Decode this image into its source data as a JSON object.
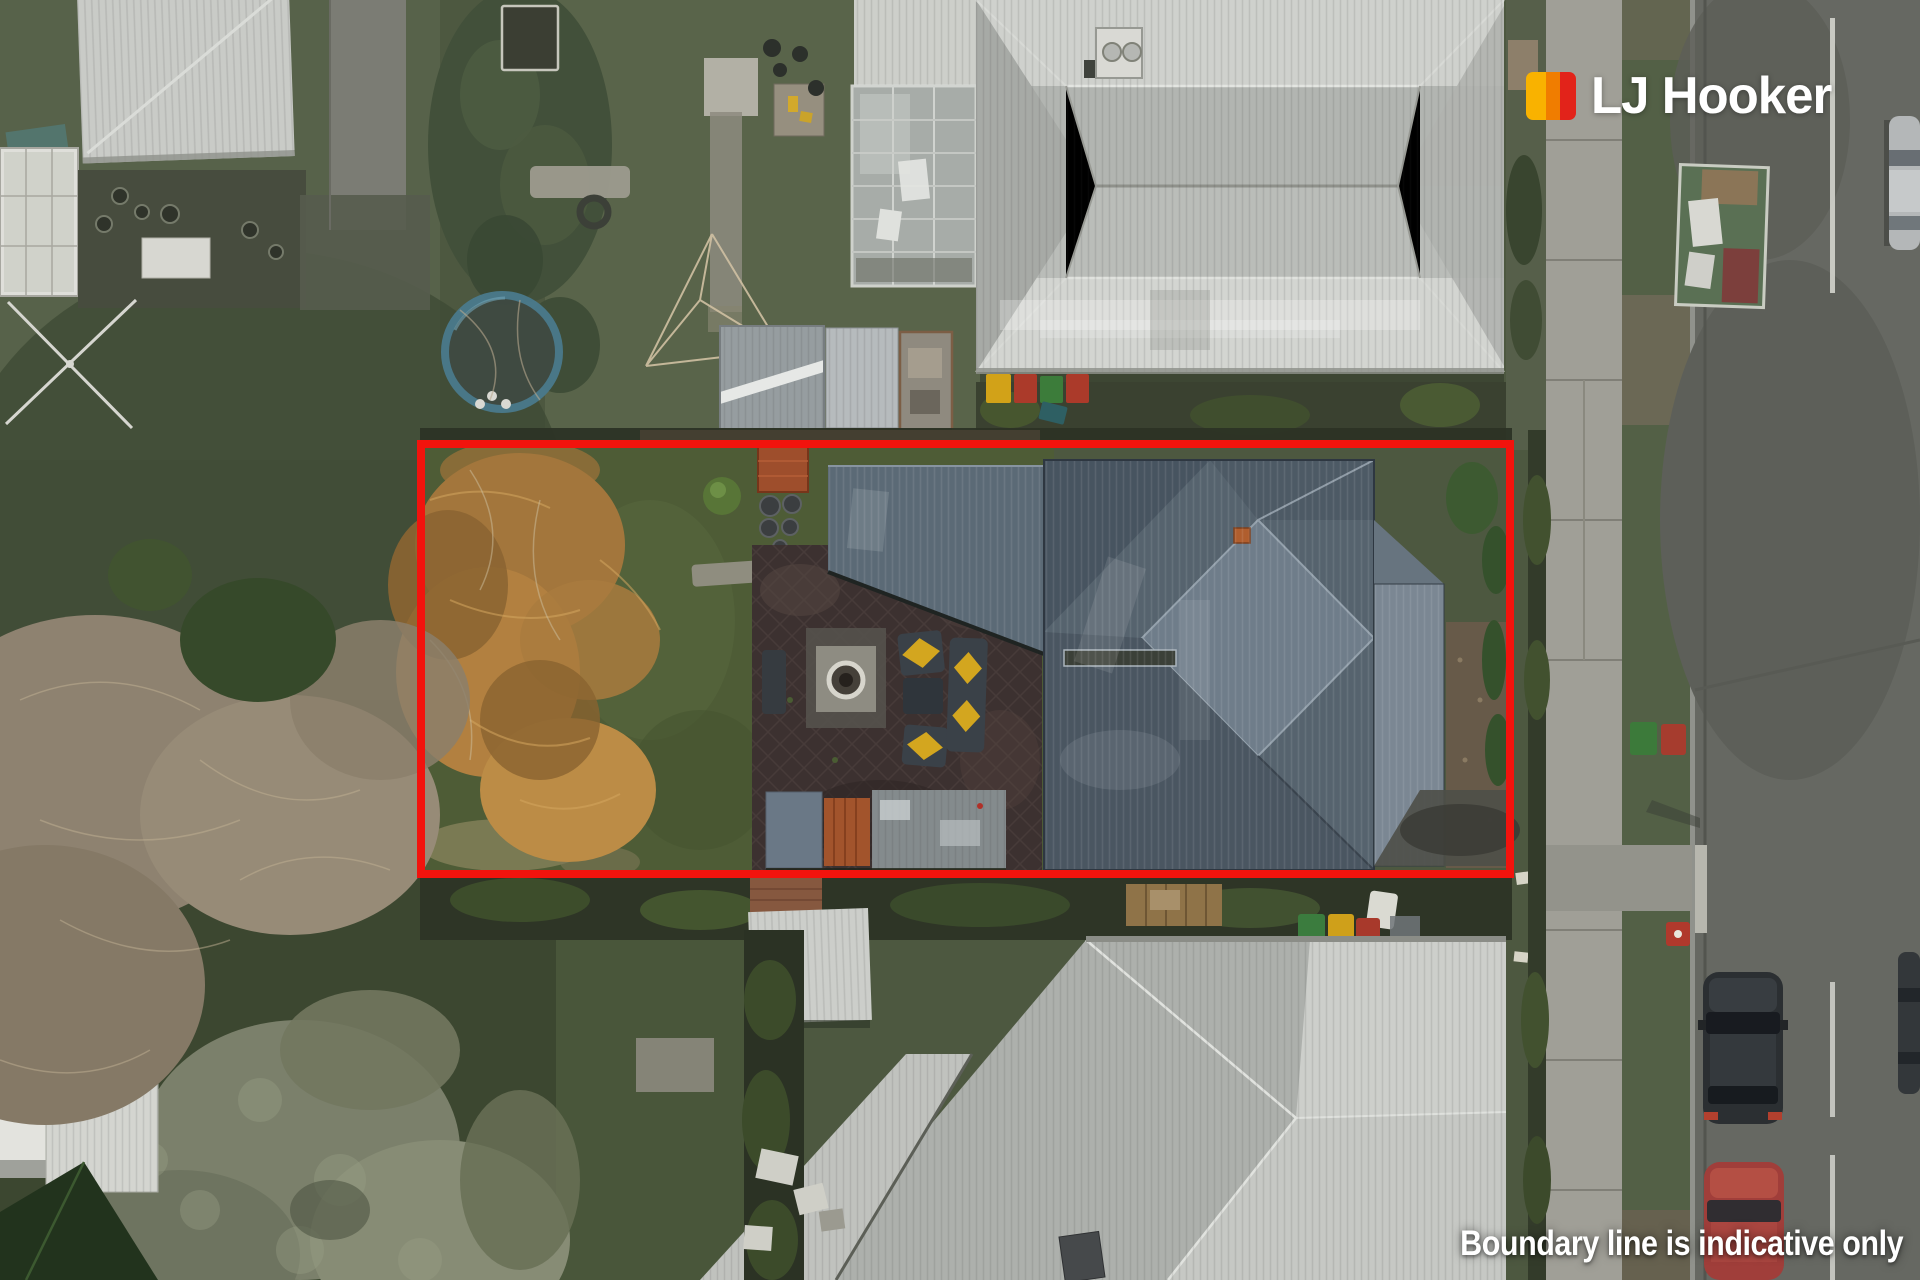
{
  "branding": {
    "logo_text": "LJ Hooker",
    "logo_mark_colors": {
      "left": "#F9B200",
      "middle": "#F07D00",
      "right": "#E2231A"
    }
  },
  "overlay": {
    "disclaimer_text": "Boundary line is indicative only",
    "boundary_color": "#F2130D"
  }
}
